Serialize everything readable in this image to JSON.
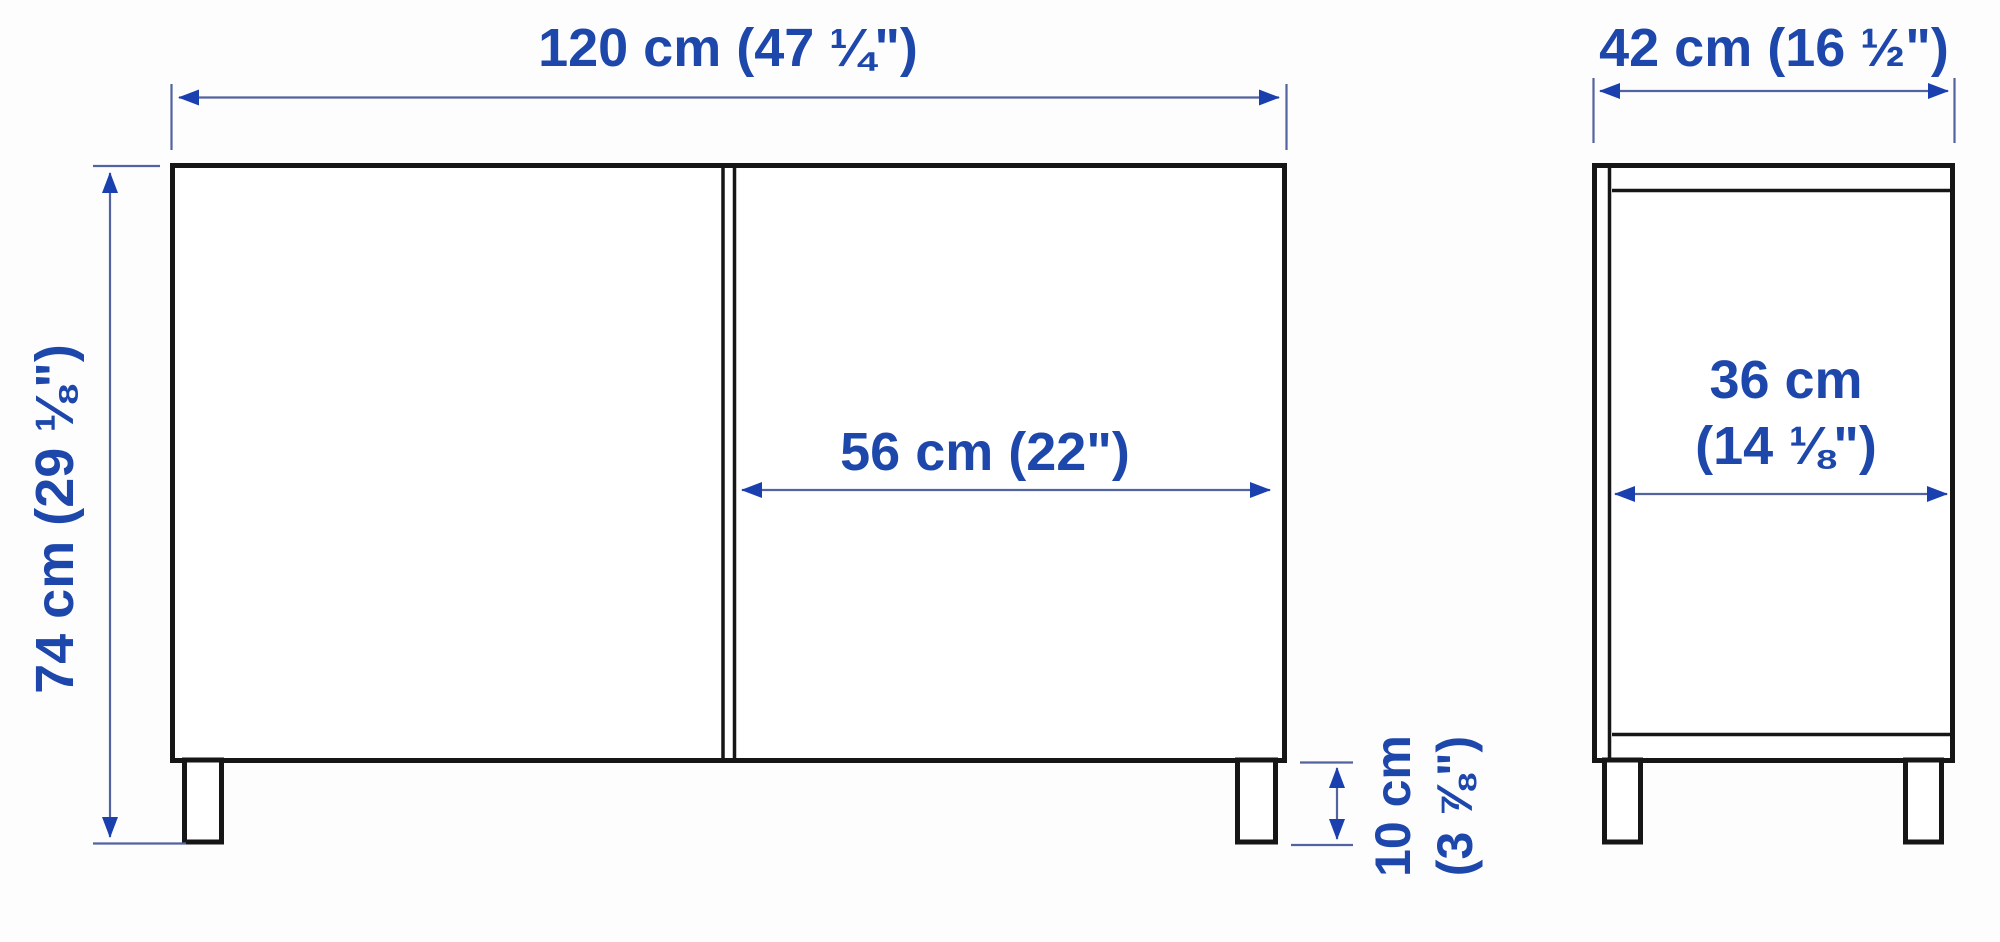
{
  "diagram": {
    "type": "furniture-dimension-drawing",
    "views": [
      "front-view",
      "side-view"
    ]
  },
  "colors": {
    "dimension_text_blue": "#1d47ab",
    "dimension_line_blue": "#52639f",
    "arrowhead_blue": "#1a3fae",
    "outline_black": "#161616",
    "background": "#fdfdfe"
  },
  "dimensions": {
    "overall_width": "120 cm (47 ¼\")",
    "overall_depth": "42 cm (16 ½\")",
    "overall_height": "74 cm (29 ⅛\")",
    "door_width": "56 cm (22\")",
    "interior_depth_line1": "36 cm",
    "interior_depth_line2": "(14 ⅛\")",
    "leg_height_line1": "10 cm",
    "leg_height_line2": "(3 ⅞\")"
  }
}
